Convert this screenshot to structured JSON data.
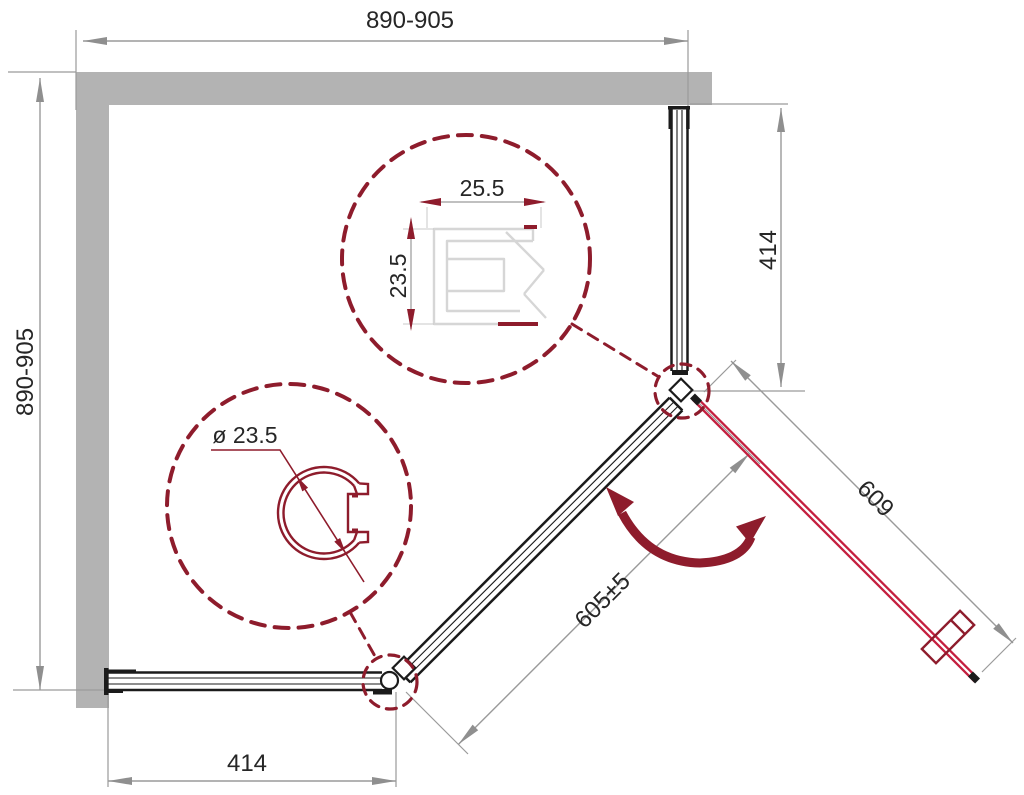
{
  "dimensions": {
    "top_width": "890-905",
    "left_width": "890-905",
    "right_segment": "414",
    "bottom_segment": "414",
    "door_width": "609",
    "fixed_panel_width": "605±5"
  },
  "detail_callouts": {
    "wall_profile": {
      "width": "25.5",
      "depth": "23.5"
    },
    "corner_post": {
      "diameter": "ø 23.5"
    }
  },
  "colors": {
    "wall": "#b3b3b3",
    "dimline": "#9a9a9a",
    "dimarrow": "#8f8f8f",
    "panel": "#1b1b1b",
    "maroon": "#8e1c2c",
    "door": "#c41f3f",
    "lightprofile": "#d6d6d6",
    "text": "#262626"
  }
}
